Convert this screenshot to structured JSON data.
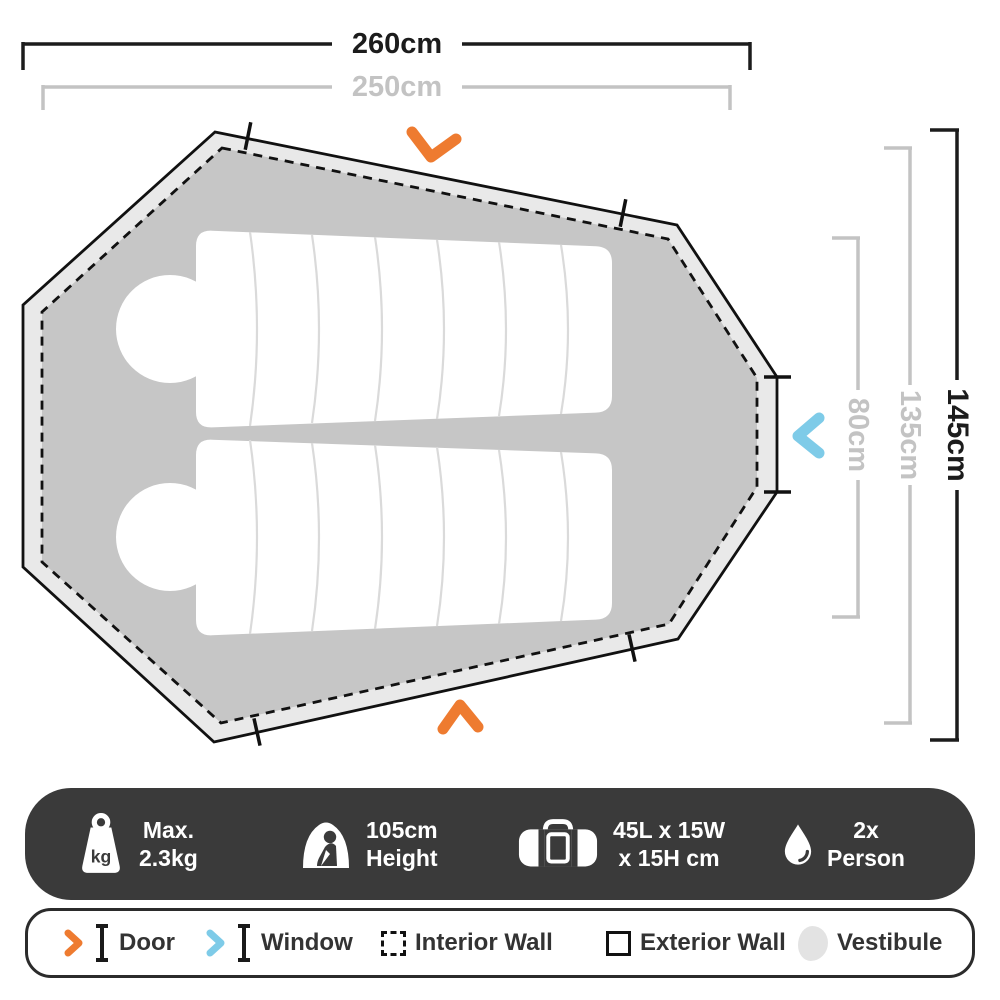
{
  "dimensions": {
    "width_outer": "260cm",
    "width_inner": "250cm",
    "height_outer": "145cm",
    "height_inner": "135cm",
    "height_pad": "80cm"
  },
  "specs": {
    "weight_icon_label": "kg",
    "items": [
      {
        "icon": "weight-icon",
        "line1": "Max.",
        "line2": "2.3kg"
      },
      {
        "icon": "height-icon",
        "line1": "105cm",
        "line2": "Height"
      },
      {
        "icon": "packed-size-icon",
        "line1": "45L x 15W",
        "line2": "x 15H cm"
      },
      {
        "icon": "capacity-icon",
        "line1": "2x",
        "line2": "Person"
      }
    ]
  },
  "legend": {
    "items": [
      {
        "icon": "door-icon",
        "label": "Door"
      },
      {
        "icon": "window-icon",
        "label": "Window"
      },
      {
        "icon": "interior-wall-icon",
        "label": "Interior Wall"
      },
      {
        "icon": "exterior-wall-icon",
        "label": "Exterior Wall"
      },
      {
        "icon": "vestibule-icon",
        "label": "Vestibule"
      }
    ]
  },
  "colors": {
    "door_accent": "#ee7b30",
    "window_accent": "#7ecbe8",
    "interior_fill": "#c6c6c6",
    "vestibule_fill": "#e9e9e9",
    "dimension_black": "#1c1c1c",
    "dimension_gray": "#c3c3c3",
    "bar_background": "#3a3a3a"
  }
}
